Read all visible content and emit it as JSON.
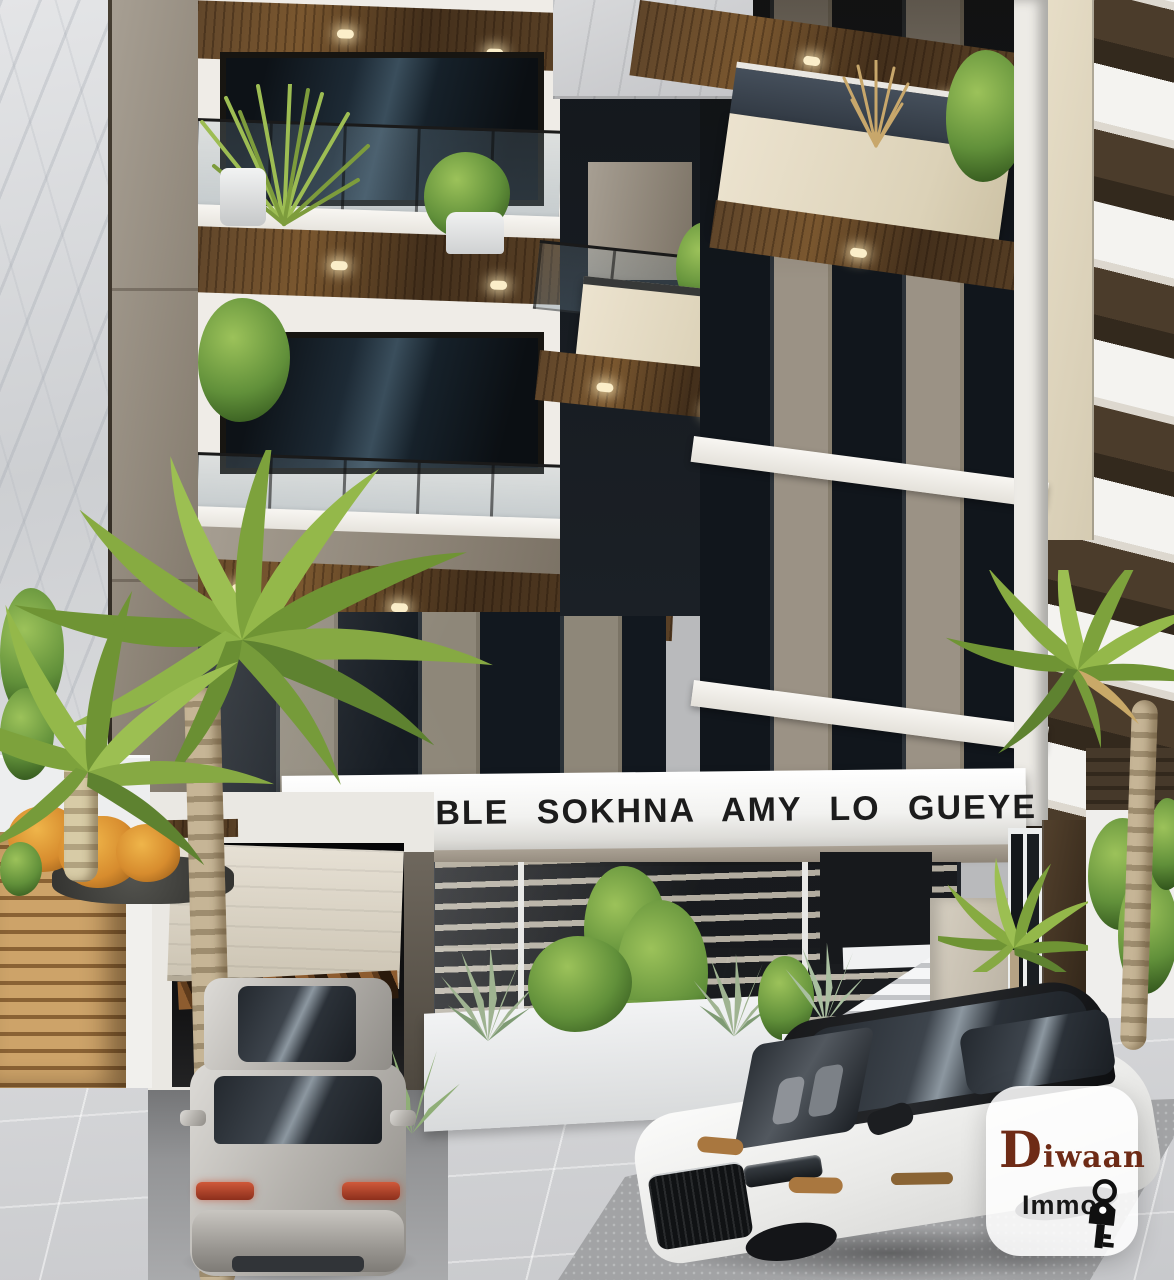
{
  "scene": {
    "description": "3D architectural render of a modern multi-storey residential building (white, taupe concrete, dark glass, wood soffits) with ground-floor garage, entry stairs, palm trees, a silver hatchback entering the garage and a white SUV parked in front",
    "building_sign": {
      "text": "IMMEUBLE SOKHNA AMY LO GUEYE",
      "band_color": "#fafafa",
      "text_color": "#1c1c1c"
    },
    "watermark": {
      "brand": "Diwaan",
      "brand_color": "#6e2b16",
      "subtitle": "Immo",
      "subtitle_color": "#161616",
      "icon": "key-icon",
      "card_color": "rgba(255,255,255,0.87)"
    },
    "palette": {
      "facade_white": "#efece7",
      "concrete_taupe": "#8d8477",
      "wood_soffit": "#5f452a",
      "stone_beige": "#e3d9c2",
      "glass_dark": "#10161c",
      "marble_light": "#dcdddf",
      "neighbor_brown": "#473828",
      "palm_green": "#7ea43b",
      "pavement": "#d3d4d6",
      "asphalt": "#a2a3a5",
      "suv_body": "#f6f6f5",
      "hatchback_body": "#b8b5b0"
    }
  }
}
